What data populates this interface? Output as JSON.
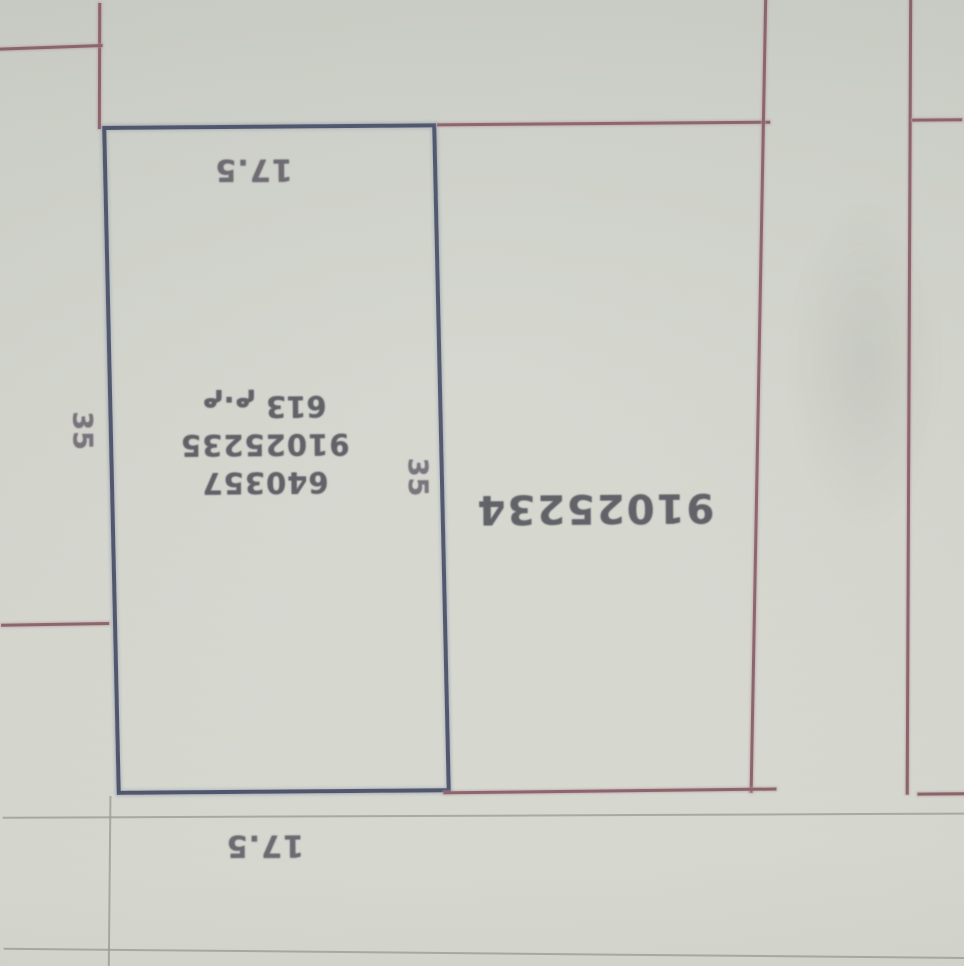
{
  "labels": {
    "dim_top": "17.5",
    "dim_bottom": "17.5",
    "dim_left": "35",
    "dim_right": "35"
  },
  "main_plot": {
    "ref_number": "640357",
    "parcel_number": "91025235",
    "area": "613 م.م"
  },
  "adjacent_plot": {
    "parcel_number": "91025234"
  },
  "colors": {
    "paper": "#d4d6ce",
    "highlight_border_blue": "#4b5269",
    "boundary_red": "#8a616b",
    "faint_line_gray": "#9fa29a",
    "ink": "#5b5b62"
  }
}
